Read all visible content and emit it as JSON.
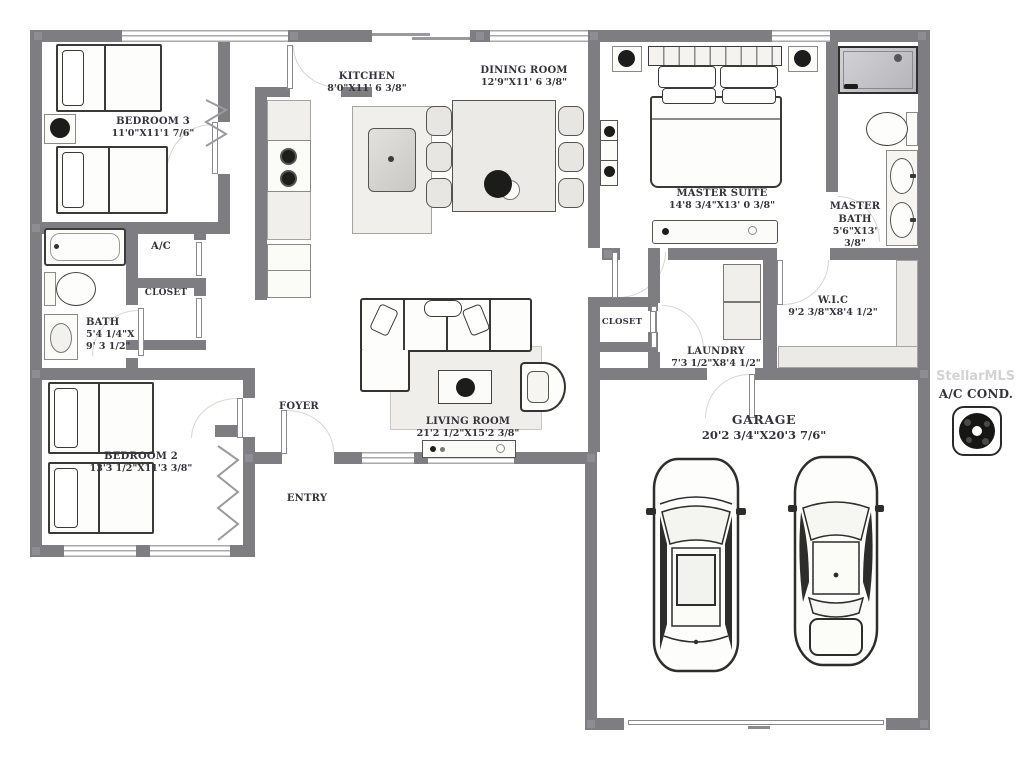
{
  "title": "Residential floor plan",
  "watermark": "StellarMLS",
  "colors": {
    "wall": "#7d7d82",
    "furniture_outline": "#3a3a38",
    "label_text": "#34333b",
    "window_line": "#a9a9ad",
    "door_arc": "#d6d6d1"
  },
  "rooms": {
    "bedroom3": {
      "name": "BEDROOM 3",
      "dims": "11'0\"X11'1 7/6\""
    },
    "kitchen": {
      "name": "KITCHEN",
      "dims": "8'0\"X11' 6 3/8\""
    },
    "dining_room": {
      "name": "DINING ROOM",
      "dims": "12'9\"X11' 6 3/8\""
    },
    "master_suite": {
      "name": "MASTER SUITE",
      "dims": "14'8 3/4\"X13' 0 3/8\""
    },
    "master_bath": {
      "name": "MASTER BATH",
      "dims": "5'6\"X13' 3/8\""
    },
    "ac_closet": {
      "name": "A/C"
    },
    "hall_closet": {
      "name": "CLOSET"
    },
    "bath": {
      "name": "BATH",
      "dims_line1": "5'4 1/4\"X",
      "dims_line2": "9' 3 1/2\""
    },
    "bedroom2": {
      "name": "BEDROOM 2",
      "dims": "13'3 1/2\"X11'3 3/8\""
    },
    "foyer": {
      "name": "FOYER"
    },
    "entry": {
      "name": "ENTRY"
    },
    "living_room": {
      "name": "LIVING ROOM",
      "dims": "21'2 1/2\"X15'2 3/8\""
    },
    "laundry_closet": {
      "name": "CLOSET"
    },
    "laundry": {
      "name": "LAUNDRY",
      "dims": "7'3 1/2\"X8'4 1/2\""
    },
    "wic": {
      "name": "W.I.C",
      "dims": "9'2 3/8\"X8'4 1/2\""
    },
    "garage": {
      "name": "GARAGE",
      "dims": "20'2 3/4\"X20'3 7/6\""
    },
    "ac_cond": {
      "name": "A/C COND."
    }
  }
}
